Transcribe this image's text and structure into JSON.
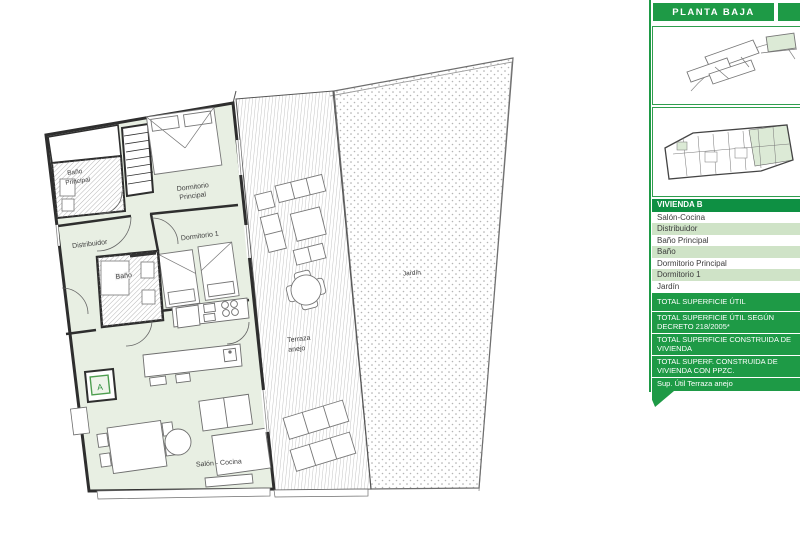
{
  "header": {
    "floor_label": "PLANTA BAJA"
  },
  "sidebar": {
    "unit_header": "VIVIENDA B",
    "rooms": [
      "Salón-Cocina",
      "Distribuidor",
      "Baño Principal",
      "Baño",
      "Dormitorio Principal",
      "Dormitorio 1",
      "Jardín"
    ],
    "totals": [
      "TOTAL SUPERFICIE ÚTIL",
      "TOTAL SUPERFICIE ÚTIL SEGÚN DECRETO 218/2005*",
      "TOTAL SUPERFICIE CONSTRUIDA DE VIVIENDA",
      "TOTAL SUPERF. CONSTRUIDA DE VIVIENDA CON PPZC.",
      "Sup. Útil Terraza anejo"
    ]
  },
  "floorplan": {
    "labels": {
      "bano_principal_line1": "Baño",
      "bano_principal_line2": "Principal",
      "dormitorio_principal_line1": "Dormitorio",
      "dormitorio_principal_line2": "Principal",
      "distribuidor": "Distribuidor",
      "dormitorio_1": "Dormitorio 1",
      "bano": "Baño",
      "salon_cocina": "Salón - Cocina",
      "terraza_line1": "Terraza",
      "terraza_line2": "anejo",
      "jardin": "Jardín",
      "lift_marker": "A"
    }
  },
  "colors": {
    "brand_green": "#1e9a46",
    "row_green": "#cfe3c7",
    "room_tint": "#e8efe3"
  }
}
